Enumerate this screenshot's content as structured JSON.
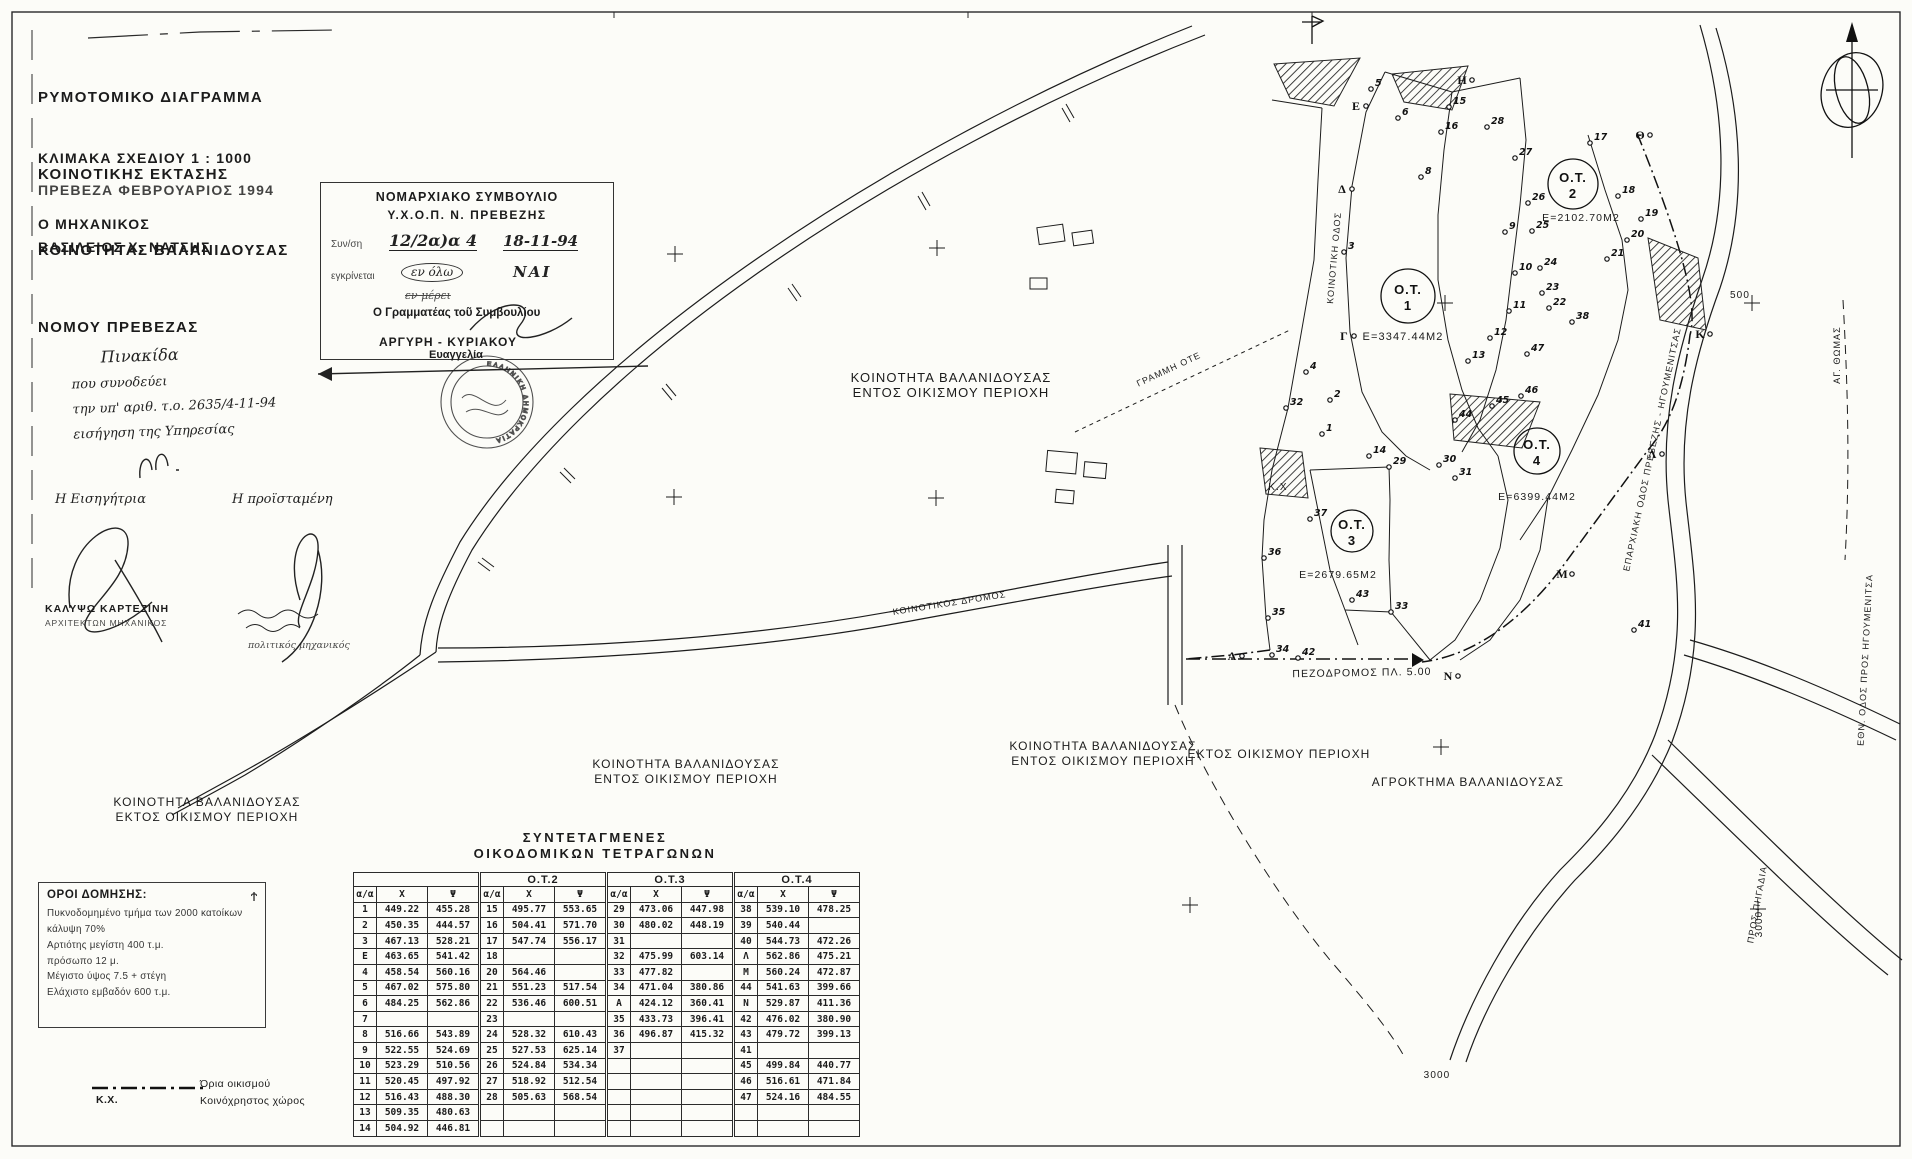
{
  "title_block": {
    "lines": [
      "ΡΥΜΟΤΟΜΙΚΟ ΔΙΑΓΡΑΜΜΑ",
      "ΚΟΙΝΟΤΙΚΗΣ ΕΚΤΑΣΗΣ",
      "ΚΟΙΝΟΤΗΤΑΣ ΒΑΛΑΝΙΔΟΥΣΑΣ",
      "ΝΟΜΟΥ ΠΡΕΒΕΖΑΣ"
    ],
    "scale": "ΚΛΙΜΑΚΑ ΣΧΕΔΙΟΥ 1 : 1000",
    "place_date": "ΠΡΕΒΕΖΑ ΦΕΒΡΟΥΑΡΙΟΣ 1994",
    "engineer_label": "Ο ΜΗΧΑΝΙΚΟΣ",
    "engineer_name": "ΒΑΣΙΛΕΙΟΣ Χ. ΝΑΤΣΗΣ"
  },
  "approval_stamp": {
    "line1": "ΝΟΜΑΡΧΙΑΚΟ ΣΥΜΒΟΥΛΙΟ",
    "line2": "Υ.Χ.Ο.Π.  Ν. ΠΡΕΒΕΖΗΣ",
    "session_label": "Συν/ση",
    "session_value": "12/2α)α 4",
    "session_date": "18-11-94",
    "approve_label": "εγκρίνεται",
    "scope_circled": "εν όλω",
    "decision": "ΝΑΙ",
    "scope_struck": "εν μέρει",
    "secretary_label": "Ο Γραμματέας τοῦ Συμβουλίου",
    "secretary_name": "ΑΡΓΥΡΗ - ΚΥΡΙΑΚΟΥ",
    "secretary_first": "Ευαγγελία"
  },
  "seal": {
    "ring_text": "ΕΛΛΗΝΙΚΗ ΔΗΜΟΚΡΑΤΙΑ"
  },
  "note": {
    "lines": [
      "Πινακίδα",
      "που συνοδεύει",
      "την υπ' αριθ. τ.ο. 2635/4-11-94",
      "εισήγηση της Υπηρεσίας"
    ]
  },
  "signatures": {
    "left_role": "Η Εισηγήτρια",
    "right_role": "Η προϊσταμένη",
    "left_name": "ΚΑΛΥΨΩ ΚΑΡΤΕΖΙΝΗ",
    "left_title": "ΑΡΧΙΤΕΚΤΩΝ ΜΗΧΑΝΙΚΟΣ",
    "right_title": "πολιτικός μηχανικός"
  },
  "building_terms": {
    "title": "ΟΡΟΙ ΔΟΜΗΣΗΣ:",
    "symbol": "Ϯ",
    "lines": [
      "Πυκνοδομημένο τμήμα των 2000 κατοίκων",
      "κάλυψη 70%",
      "Αρτιότης μεγίστη 400 τ.μ.",
      "πρόσωπο 12 μ.",
      "Μέγιστο ύψος 7.5 + στέγη",
      "Ελάχιστο εμβαδόν 600 τ.μ."
    ]
  },
  "legend": {
    "boundary_label": "Όρια οικισμού",
    "kx_abbr": "Κ.Χ.",
    "kx_label": "Κοινόχρηστος χώρος"
  },
  "table": {
    "title1": "ΣΥΝΤΕΤΑΓΜΕΝΕΣ",
    "title2": "ΟΙΚΟΔΟΜΙΚΩΝ ΤΕΤΡΑΓΩΝΩΝ",
    "group_headers": [
      "",
      "Ο.Τ.2",
      "Ο.Τ.3",
      "Ο.Τ.4"
    ],
    "col_headers": [
      "α/α",
      "Χ",
      "Ψ"
    ],
    "rows": [
      [
        "1",
        "449.22",
        "455.28",
        "15",
        "495.77",
        "553.65",
        "29",
        "473.06",
        "447.98",
        "38",
        "539.10",
        "478.25"
      ],
      [
        "2",
        "450.35",
        "444.57",
        "16",
        "504.41",
        "571.70",
        "30",
        "480.02",
        "448.19",
        "39",
        "540.44",
        ""
      ],
      [
        "3",
        "467.13",
        "528.21",
        "17",
        "547.74",
        "556.17",
        "31",
        "",
        "",
        "40",
        "544.73",
        "472.26"
      ],
      [
        "Ε",
        "463.65",
        "541.42",
        "18",
        "",
        "",
        "32",
        "475.99",
        "603.14",
        "Λ",
        "562.86",
        "475.21"
      ],
      [
        "4",
        "458.54",
        "560.16",
        "20",
        "564.46",
        "",
        "33",
        "477.82",
        "",
        "Μ",
        "560.24",
        "472.87"
      ],
      [
        "5",
        "467.02",
        "575.80",
        "21",
        "551.23",
        "517.54",
        "34",
        "471.04",
        "380.86",
        "44",
        "541.63",
        "399.66"
      ],
      [
        "6",
        "484.25",
        "562.86",
        "22",
        "536.46",
        "600.51",
        "Α",
        "424.12",
        "360.41",
        "Ν",
        "529.87",
        "411.36"
      ],
      [
        "7",
        "",
        "",
        "23",
        "",
        "",
        "35",
        "433.73",
        "396.41",
        "42",
        "476.02",
        "380.90"
      ],
      [
        "8",
        "516.66",
        "543.89",
        "24",
        "528.32",
        "610.43",
        "36",
        "496.87",
        "415.32",
        "43",
        "479.72",
        "399.13"
      ],
      [
        "9",
        "522.55",
        "524.69",
        "25",
        "527.53",
        "625.14",
        "37",
        "",
        "",
        "41",
        "",
        ""
      ],
      [
        "10",
        "523.29",
        "510.56",
        "26",
        "524.84",
        "534.34",
        "",
        "",
        "",
        "45",
        "499.84",
        "440.77"
      ],
      [
        "11",
        "520.45",
        "497.92",
        "27",
        "518.92",
        "512.54",
        "",
        "",
        "",
        "46",
        "516.61",
        "471.84"
      ],
      [
        "12",
        "516.43",
        "488.30",
        "28",
        "505.63",
        "568.54",
        "",
        "",
        "",
        "47",
        "524.16",
        "484.55"
      ],
      [
        "13",
        "509.35",
        "480.63",
        "",
        "",
        "",
        "",
        "",
        "",
        "",
        "",
        ""
      ],
      [
        "14",
        "504.92",
        "446.81",
        "",
        "",
        "",
        "",
        "",
        "",
        "",
        "",
        ""
      ]
    ]
  },
  "map": {
    "ot_circles": [
      {
        "x": 1408,
        "y": 296,
        "r": 27,
        "line1": "Ο.Τ.",
        "line2": "1"
      },
      {
        "x": 1573,
        "y": 184,
        "r": 25,
        "line1": "Ο.Τ.",
        "line2": "2"
      },
      {
        "x": 1352,
        "y": 531,
        "r": 21,
        "line1": "Ο.Τ.",
        "line2": "3"
      },
      {
        "x": 1537,
        "y": 451,
        "r": 23,
        "line1": "Ο.Τ.",
        "line2": "4"
      }
    ],
    "labels": [
      {
        "t": "ΚΟΙΝΟΤΗΤΑ ΒΑΛΑΝΙΔΟΥΣΑΣ\nΕΝΤΟΣ ΟΙΚΙΣΜΟΥ ΠΕΡΙΟΧΗ",
        "x": 951,
        "y": 382,
        "s": 13
      },
      {
        "t": "ΚΟΙΝΟΤΗΤΑ ΒΑΛΑΝΙΔΟΥΣΑΣ\nΕΝΤΟΣ ΟΙΚΙΣΜΟΥ ΠΕΡΙΟΧΗ",
        "x": 1103,
        "y": 750,
        "s": 12
      },
      {
        "t": "ΚΟΙΝΟΤΗΤΑ ΒΑΛΑΝΙΔΟΥΣΑΣ\nΕΝΤΟΣ ΟΙΚΙΣΜΟΥ ΠΕΡΙΟΧΗ",
        "x": 686,
        "y": 768,
        "s": 12
      },
      {
        "t": "ΚΟΙΝΟΤΗΤΑ ΒΑΛΑΝΙΔΟΥΣΑΣ\nΕΚΤΟΣ ΟΙΚΙΣΜΟΥ ΠΕΡΙΟΧΗ",
        "x": 207,
        "y": 806,
        "s": 12
      },
      {
        "t": "ΕΚΤΟΣ ΟΙΚΙΣΜΟΥ ΠΕΡΙΟΧΗ",
        "x": 1279,
        "y": 758,
        "s": 12
      },
      {
        "t": "ΑΓΡΟΚΤΗΜΑ ΒΑΛΑΝΙΔΟΥΣΑΣ",
        "x": 1468,
        "y": 786,
        "s": 12
      },
      {
        "t": "ΠΕΖΟΔΡΟΜΟΣ ΠΛ. 5.00",
        "x": 1362,
        "y": 676,
        "s": 10.5,
        "r": -1
      },
      {
        "t": "Ε=3347.44Μ2",
        "x": 1403,
        "y": 340,
        "s": 11
      },
      {
        "t": "Ε=2102.70Μ2",
        "x": 1581,
        "y": 221,
        "s": 10.5
      },
      {
        "t": "Ε=2679.65Μ2",
        "x": 1338,
        "y": 578,
        "s": 10.5
      },
      {
        "t": "Ε=6399.44Μ2",
        "x": 1537,
        "y": 500,
        "s": 10.5
      },
      {
        "t": "ΓΡΑΜΜΗ ΟΤΕ",
        "x": 1170,
        "y": 372,
        "s": 9,
        "r": -25
      },
      {
        "t": "Κ.Χ",
        "x": 1278,
        "y": 490,
        "s": 10
      },
      {
        "t": "ΚΟΙΝΟΤΙΚΗ ΟΔΟΣ",
        "x": 1337,
        "y": 258,
        "s": 9,
        "r": -85
      },
      {
        "t": "ΚΟΙΝΟΤΙΚΟΣ ΔΡΟΜΟΣ",
        "x": 950,
        "y": 606,
        "s": 9,
        "r": -9
      },
      {
        "t": "ΕΠΑΡΧΙΑΚΗ ΟΔΟΣ ΠΡΕΒΕΖΗΣ - ΗΓΟΥΜΕΝΙΤΣΑΣ",
        "x": 1655,
        "y": 450,
        "s": 9,
        "r": -78
      },
      {
        "t": "ΑΓ. ΘΩΜΑΣ",
        "x": 1840,
        "y": 355,
        "s": 9,
        "r": -90
      },
      {
        "t": "ΕΘΝ. ΟΔΟΣ ΠΡΟΣ ΗΓΟΥΜΕΝΙΤΣΑ",
        "x": 1868,
        "y": 660,
        "s": 9,
        "r": -87
      },
      {
        "t": "ΠΡΟΣ ΠΗΓΑΔΙΑ",
        "x": 1760,
        "y": 905,
        "s": 9,
        "r": -80
      },
      {
        "t": "500",
        "x": 1740,
        "y": 298,
        "s": 10
      },
      {
        "t": "3000",
        "x": 1762,
        "y": 924,
        "s": 10,
        "r": -90
      },
      {
        "t": "3000",
        "x": 1437,
        "y": 1078,
        "s": 10
      }
    ],
    "letters": [
      {
        "n": "Ε",
        "x": 1356,
        "y": 102
      },
      {
        "n": "Δ",
        "x": 1342,
        "y": 185
      },
      {
        "n": "Γ",
        "x": 1344,
        "y": 332
      },
      {
        "n": "Η",
        "x": 1462,
        "y": 76
      },
      {
        "n": "Θ",
        "x": 1640,
        "y": 131
      },
      {
        "n": "Κ",
        "x": 1700,
        "y": 330
      },
      {
        "n": "Λ",
        "x": 1652,
        "y": 450
      },
      {
        "n": "Μ",
        "x": 1562,
        "y": 570
      },
      {
        "n": "Ν",
        "x": 1448,
        "y": 672
      },
      {
        "n": "Α",
        "x": 1232,
        "y": 652
      }
    ],
    "points": [
      {
        "n": "1",
        "x": 1322,
        "y": 434
      },
      {
        "n": "2",
        "x": 1330,
        "y": 400
      },
      {
        "n": "3",
        "x": 1344,
        "y": 252
      },
      {
        "n": "4",
        "x": 1306,
        "y": 372
      },
      {
        "n": "5",
        "x": 1371,
        "y": 89
      },
      {
        "n": "6",
        "x": 1398,
        "y": 118
      },
      {
        "n": "8",
        "x": 1421,
        "y": 177
      },
      {
        "n": "9",
        "x": 1505,
        "y": 232
      },
      {
        "n": "10",
        "x": 1515,
        "y": 273
      },
      {
        "n": "11",
        "x": 1509,
        "y": 311
      },
      {
        "n": "12",
        "x": 1490,
        "y": 338
      },
      {
        "n": "13",
        "x": 1468,
        "y": 361
      },
      {
        "n": "14",
        "x": 1369,
        "y": 456
      },
      {
        "n": "15",
        "x": 1449,
        "y": 107
      },
      {
        "n": "16",
        "x": 1441,
        "y": 132
      },
      {
        "n": "17",
        "x": 1590,
        "y": 143
      },
      {
        "n": "18",
        "x": 1618,
        "y": 196
      },
      {
        "n": "19",
        "x": 1641,
        "y": 219
      },
      {
        "n": "20",
        "x": 1627,
        "y": 240
      },
      {
        "n": "21",
        "x": 1607,
        "y": 259
      },
      {
        "n": "22",
        "x": 1549,
        "y": 308
      },
      {
        "n": "23",
        "x": 1542,
        "y": 293
      },
      {
        "n": "24",
        "x": 1540,
        "y": 268
      },
      {
        "n": "25",
        "x": 1532,
        "y": 231
      },
      {
        "n": "26",
        "x": 1528,
        "y": 203
      },
      {
        "n": "27",
        "x": 1515,
        "y": 158
      },
      {
        "n": "28",
        "x": 1487,
        "y": 127
      },
      {
        "n": "29",
        "x": 1389,
        "y": 467
      },
      {
        "n": "30",
        "x": 1439,
        "y": 465
      },
      {
        "n": "31",
        "x": 1455,
        "y": 478
      },
      {
        "n": "32",
        "x": 1286,
        "y": 408
      },
      {
        "n": "33",
        "x": 1391,
        "y": 612
      },
      {
        "n": "34",
        "x": 1272,
        "y": 655
      },
      {
        "n": "35",
        "x": 1268,
        "y": 618
      },
      {
        "n": "36",
        "x": 1264,
        "y": 558
      },
      {
        "n": "37",
        "x": 1310,
        "y": 519
      },
      {
        "n": "38",
        "x": 1572,
        "y": 322
      },
      {
        "n": "41",
        "x": 1634,
        "y": 630
      },
      {
        "n": "42",
        "x": 1298,
        "y": 658
      },
      {
        "n": "43",
        "x": 1352,
        "y": 600
      },
      {
        "n": "44",
        "x": 1455,
        "y": 420
      },
      {
        "n": "45",
        "x": 1492,
        "y": 406
      },
      {
        "n": "46",
        "x": 1521,
        "y": 396
      },
      {
        "n": "47",
        "x": 1527,
        "y": 354
      }
    ],
    "crosses": [
      [
        675,
        254
      ],
      [
        937,
        248
      ],
      [
        936,
        498
      ],
      [
        674,
        497
      ],
      [
        1445,
        303
      ],
      [
        1441,
        747
      ],
      [
        1190,
        905
      ],
      [
        1752,
        303
      ],
      [
        1758,
        909
      ]
    ]
  }
}
